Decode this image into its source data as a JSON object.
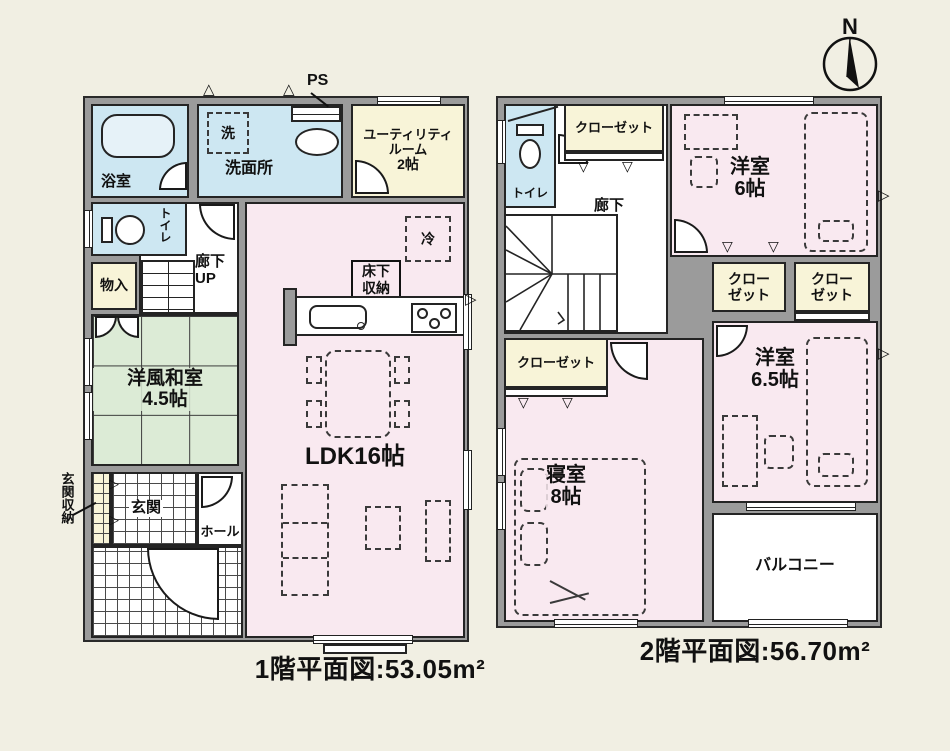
{
  "colors": {
    "background": "#f1efe3",
    "wall_gray": "#9b9b9b",
    "water_blue": "#cde7f2",
    "closet_yellow": "#f8f4d8",
    "room_pink": "#f9e9f0",
    "tatami_green": "#dcebd6",
    "line_black": "#242424"
  },
  "icons": {
    "vent_triangle": "△",
    "folding_door": "▽",
    "cabinet_door": "▷",
    "wall_vent": "▷"
  },
  "compass": {
    "north_label": "N"
  },
  "floor1": {
    "caption": "1階平面図:53.05m²",
    "labels": {
      "bath": "浴室",
      "washer": "洗",
      "washroom": "洗面所",
      "ps": "PS",
      "utility1": "ユーティリティ",
      "utility2": "ルーム",
      "utility3": "2帖",
      "toilet": "トイレ",
      "storage": "物入",
      "corridor": "廊下",
      "up": "UP",
      "fridge": "冷",
      "underfloor1": "床下",
      "underfloor2": "収納",
      "washitsu1": "洋風和室",
      "washitsu2": "4.5帖",
      "ldk": "LDK16帖",
      "genkan": "玄関",
      "hall": "ホール",
      "genkan_storage": "玄関収納"
    }
  },
  "floor2": {
    "caption": "2階平面図:56.70m²",
    "labels": {
      "toilet": "トイレ",
      "closet_top": "クローゼット",
      "corridor": "廊下",
      "dn": "DN",
      "room6_1": "洋室",
      "room6_2": "6帖",
      "closet_a1": "クロー",
      "closet_a2": "ゼット",
      "closet_b1": "クロー",
      "closet_b2": "ゼット",
      "closet_left": "クローゼット",
      "master1": "寝室",
      "master2": "8帖",
      "room65_1": "洋室",
      "room65_2": "6.5帖",
      "balcony": "バルコニー"
    }
  }
}
